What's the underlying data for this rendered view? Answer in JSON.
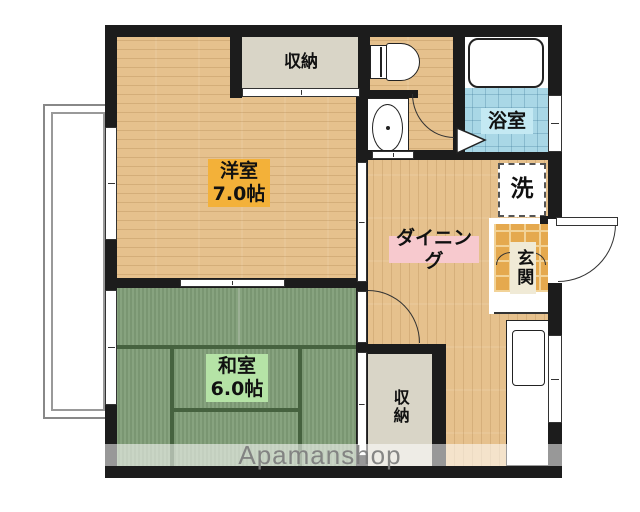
{
  "rooms": {
    "western_room": {
      "name": "洋室",
      "size": "7.0帖"
    },
    "japanese_room": {
      "name": "和室",
      "size": "6.0帖"
    },
    "dining": {
      "name": "ダイニング"
    },
    "bath": {
      "name": "浴室"
    },
    "entrance": {
      "name": "玄関"
    },
    "laundry": {
      "name": "洗"
    },
    "storage_top": {
      "name": "収納"
    },
    "storage_bottom": {
      "name": "収納"
    }
  },
  "watermark": {
    "text": "Apamanshop"
  },
  "colors": {
    "wall": "#1c1c1c",
    "wood_floor": "#e6c18d",
    "tatami": "#819e78",
    "bath_floor": "#a9d7e6",
    "entrance_tile": "#e5a94e",
    "storage": "#d9d5c7",
    "label_western_room": "#f3b139",
    "label_japanese_room": "#b5e3a6",
    "label_dining": "#f7c9ce",
    "label_bath": "#c4e9f3",
    "label_entrance": "#f0ead6",
    "watermark_gray": "#7d7d7d"
  }
}
